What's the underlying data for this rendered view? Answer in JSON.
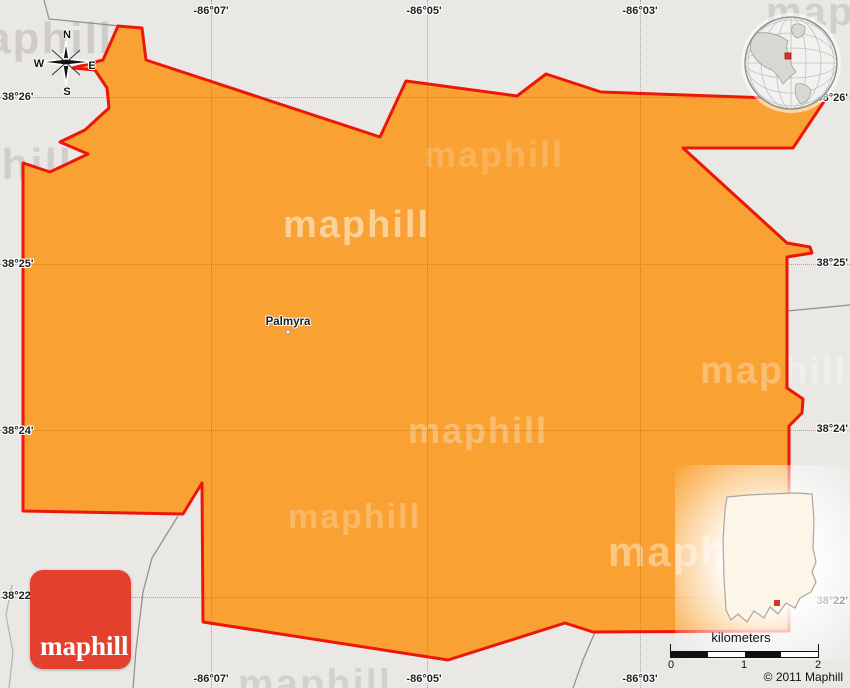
{
  "map": {
    "place_label": "Palmyra",
    "grid": {
      "top": [
        "-86°07'",
        "-86°05'",
        "-86°03'"
      ],
      "bottom": [
        "-86°07'",
        "-86°05'",
        "-86°03'"
      ],
      "left": [
        "38°26'",
        "38°25'",
        "38°24'",
        "38°22'"
      ],
      "right": [
        "38°26'",
        "38°25'",
        "38°24'",
        "38°22'"
      ]
    },
    "compass": {
      "north": "N",
      "south": "S",
      "east": "E",
      "west": "W"
    }
  },
  "branding": {
    "logo_text": "maphill",
    "watermark_text": "maphill",
    "copyright": "© 2011 Maphill"
  },
  "scalebar": {
    "title": "kilometers",
    "ticks": [
      "0",
      "1",
      "2"
    ]
  },
  "colors": {
    "region_fill": "#F9A233",
    "region_border": "#ED1709",
    "background": "#EAE8E5",
    "logo_red": "#E3402E",
    "marker_red": "#D93425"
  }
}
